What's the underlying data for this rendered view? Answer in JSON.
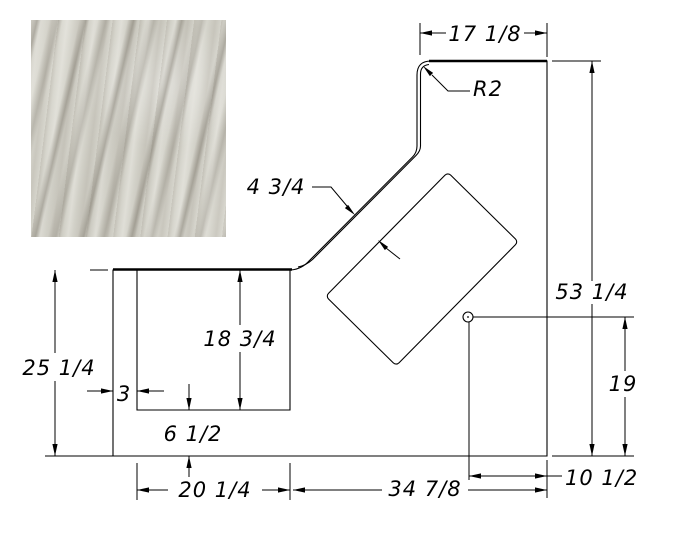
{
  "drawing": {
    "title": "countertop-shop-drawing",
    "background": "#ffffff",
    "line_color": "#000000",
    "material_swatch": {
      "base_color": "#d8d7cf",
      "vein_color": "#8e887c"
    },
    "dimensions": {
      "top_width": "17 1/8",
      "corner_radius": "R2",
      "diagonal_edge": "4 3/4",
      "right_height": "53 1/4",
      "faucet_height": "19",
      "left_height": "25 1/4",
      "cutout_height": "18 3/4",
      "cutout_left_offset": "3",
      "cutout_front_offset": "6 1/2",
      "cutout_width": "20 1/4",
      "bottom_width": "34 7/8",
      "faucet_right_offset": "10 1/2"
    }
  }
}
